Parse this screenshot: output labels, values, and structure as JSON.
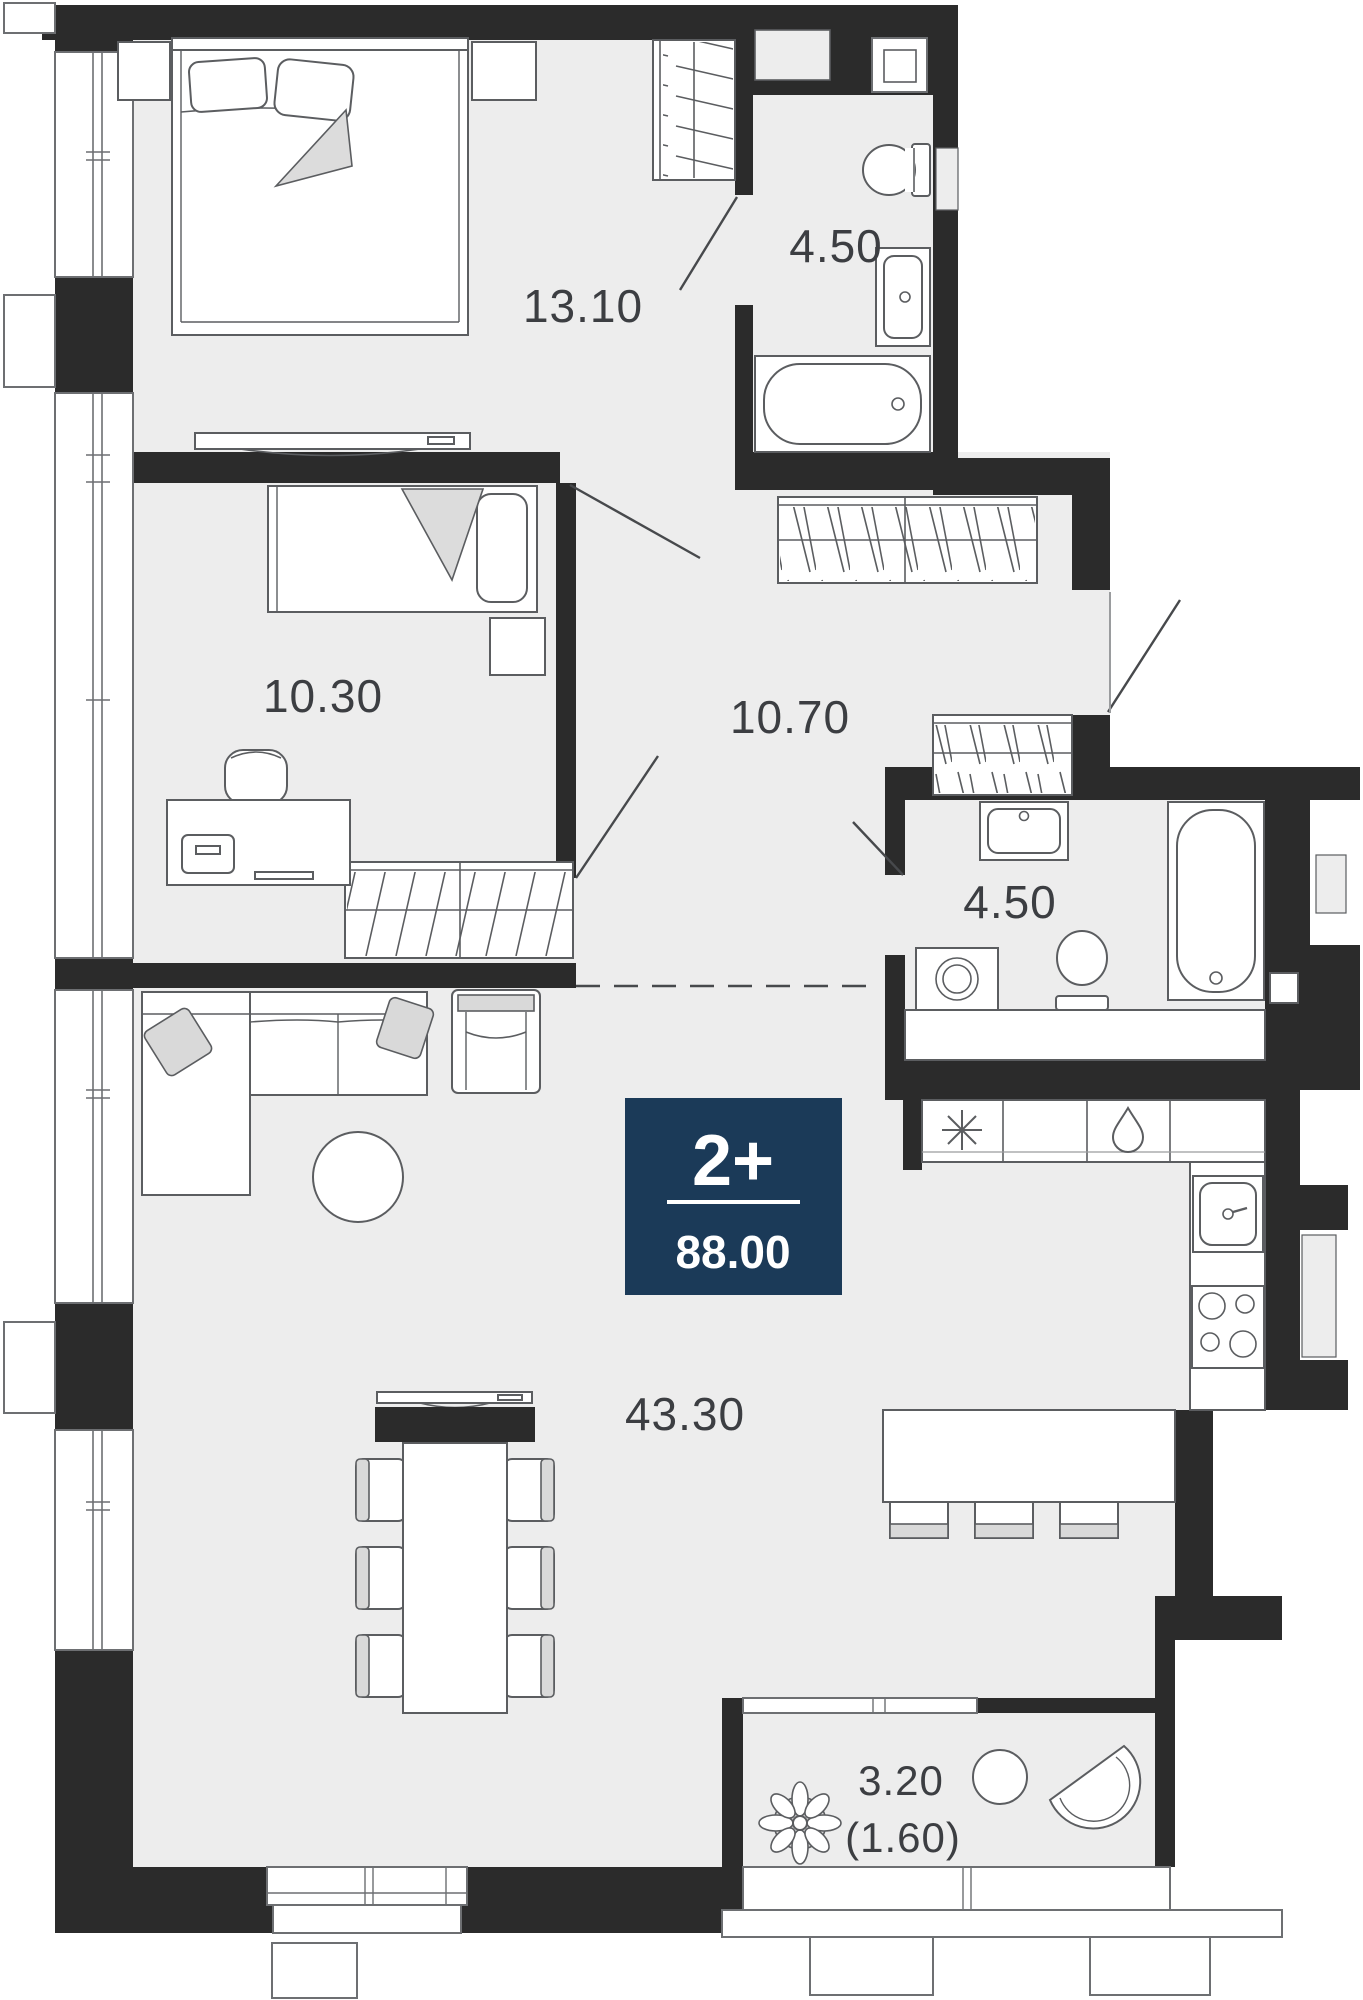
{
  "plan": {
    "type": "apartment-floor-plan",
    "badge": {
      "rooms_label": "2+",
      "area_total": "88.00",
      "color": "#1b3a58"
    },
    "rooms": {
      "bedroom_main": {
        "area": "13.10"
      },
      "bathroom_top": {
        "area": "4.50"
      },
      "bedroom_second": {
        "area": "10.30"
      },
      "hallway": {
        "area": "10.70"
      },
      "bathroom_middle": {
        "area": "4.50"
      },
      "living_kitchen": {
        "area": "43.30"
      },
      "balcony": {
        "area": "3.20",
        "area_reduced": "(1.60)"
      }
    },
    "icons": [
      "plant-icon",
      "stove-burners-icon",
      "freezer-asterisk-icon",
      "water-drop-icon"
    ],
    "colors": {
      "wall": "#2b2b2b",
      "floor": "#ededed",
      "accent": "#1b3a58",
      "furniture_line": "#5b5d60",
      "text": "#3c3e42"
    }
  }
}
